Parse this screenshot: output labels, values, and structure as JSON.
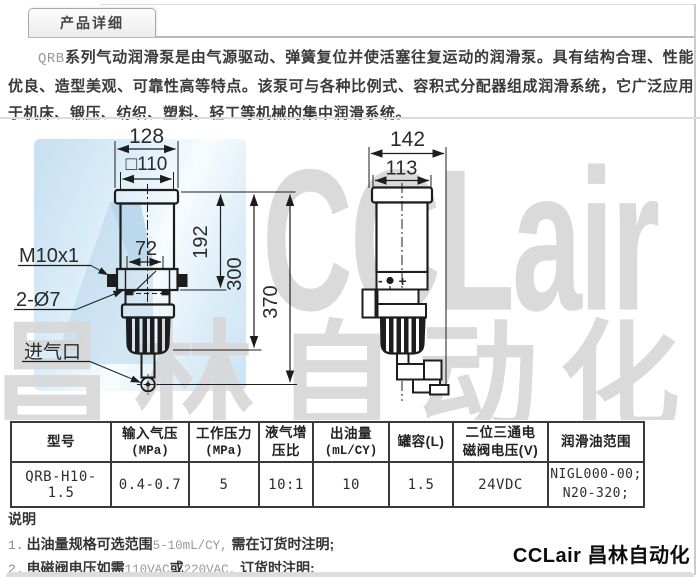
{
  "colors": {
    "watermark_blue": "#cfe4f3",
    "watermark_gray": "#d9d9d9",
    "table_border": "#3a3a3a",
    "line_color": "#1d1d1d"
  },
  "tab": {
    "label": "产品详细"
  },
  "intro": {
    "prefix": "QRB",
    "text": "系列气动润滑泵是由气源驱动、弹簧复位并使活塞往复运动的润滑泵。具有结构合理、性能优良、造型美观、可靠性高等特点。该泵可与各种比例式、容积式分配器组成润滑系统，它广泛应用于机床、锻压、纺织、塑料、轻工等机械的集中润滑系统。"
  },
  "watermark": {
    "logo": "CCLair",
    "cn": "昌林自动化"
  },
  "drawing": {
    "front": {
      "overall_width": "128",
      "body_width_label": "□110",
      "bracket_span": "72",
      "h_body": "192",
      "h_mid": "300",
      "h_total": "370",
      "thread_label": "M10x1",
      "holes_label": "2-Ø7",
      "inlet_label": "进气口"
    },
    "side": {
      "overall_width": "142",
      "body_width": "113",
      "minus": "-",
      "plus": "+"
    }
  },
  "table": {
    "headers": [
      {
        "line1": "型号",
        "line2": ""
      },
      {
        "line1": "输入气压",
        "line2": "(MPa)"
      },
      {
        "line1": "工作压力",
        "line2": "(MPa)"
      },
      {
        "line1": "液气增",
        "line2": "压比"
      },
      {
        "line1": "出油量",
        "line2": "(mL/CY)"
      },
      {
        "line1": "罐容(L)",
        "line2": ""
      },
      {
        "line1": "二位三通电",
        "line2": "磁阀电压(V)"
      },
      {
        "line1": "润滑油范围",
        "line2": ""
      }
    ],
    "row": {
      "model": "QRB-H10-1.5",
      "input_pressure": "0.4-0.7",
      "working_pressure": "5",
      "boost_ratio": "10:1",
      "oil_output": "10",
      "tank_capacity": "1.5",
      "valve_voltage": "24VDC",
      "oil_range_line1": "NIGL000-00;",
      "oil_range_line2": "N20-320;"
    }
  },
  "notes": {
    "title": "说明",
    "items": [
      {
        "no": "1.",
        "b1": "出油量规格可选范围",
        "g1": "5-10mL/CY,",
        "b2": "需在订货时注明;"
      },
      {
        "no": "2.",
        "b1": "电磁阀电压如需",
        "g1": "110VAC",
        "b2": "或",
        "g2": "220VAC,",
        "b3": "订货时注明;"
      }
    ]
  },
  "footer": {
    "brand": "CCLair 昌林自动化"
  }
}
